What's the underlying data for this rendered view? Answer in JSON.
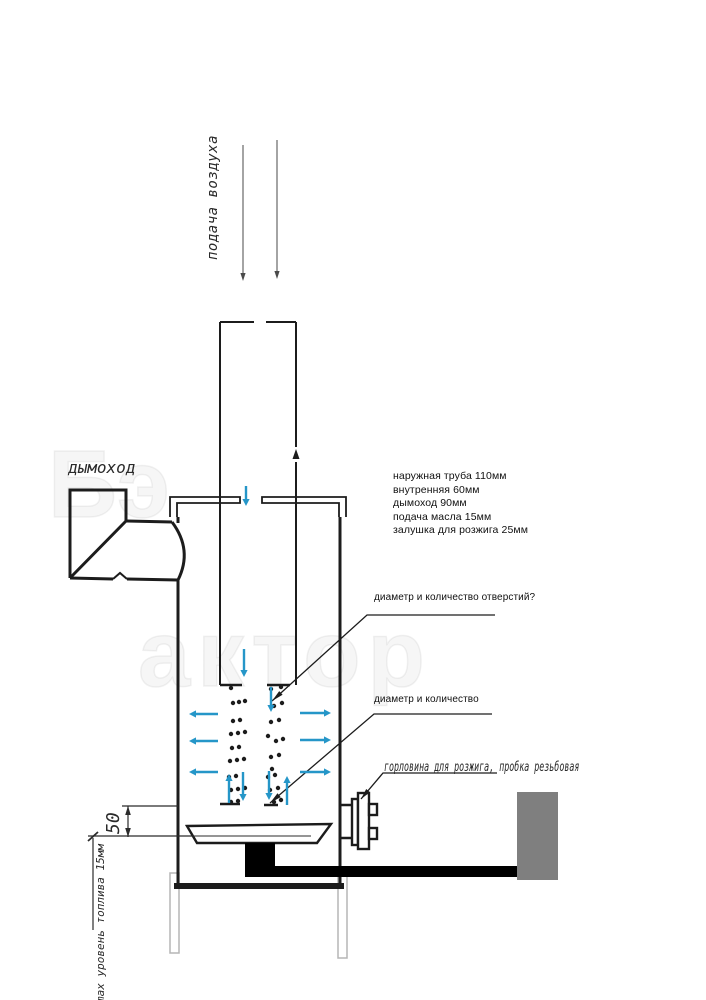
{
  "labels": {
    "air_supply": "подача воздуха",
    "chimney": "дымоход",
    "dim_50": "50",
    "max_fuel_level": "max уровень топлива 15мм",
    "ignition_port": "горловина для розжига, пробка резьбовая",
    "holes_question_top": "диаметр и количество отверстий?",
    "holes_question_bottom": "диаметр и количество",
    "specs": [
      "наружная труба 110мм",
      "внутренняя 60мм",
      "дымоход 90мм",
      "подача масла 15мм",
      "залушка для розжига 25мм"
    ]
  },
  "watermark": {
    "fragment_top": "Бэ",
    "fragment_mid": "актор"
  },
  "colors": {
    "line": "#1c1c1c",
    "flow_arrow": "#2596c8",
    "air_arrow": "#4a4a4a",
    "oil_pipe": "#000000",
    "oil_tank": "#7f7f7f",
    "dimension": "#2b2b2b",
    "legs": "#b5b5b5"
  },
  "diagram": {
    "flow_arrows": [
      {
        "x1": 246,
        "y1": 486,
        "x2": 246,
        "y2": 506
      },
      {
        "x1": 244,
        "y1": 649,
        "x2": 244,
        "y2": 677
      },
      {
        "x1": 271,
        "y1": 687,
        "x2": 271,
        "y2": 712
      },
      {
        "x1": 243,
        "y1": 772,
        "x2": 243,
        "y2": 801
      },
      {
        "x1": 269,
        "y1": 771,
        "x2": 269,
        "y2": 800
      },
      {
        "x1": 229,
        "y1": 803,
        "x2": 229,
        "y2": 774
      },
      {
        "x1": 287,
        "y1": 805,
        "x2": 287,
        "y2": 776
      },
      {
        "x1": 218,
        "y1": 714,
        "x2": 189,
        "y2": 714
      },
      {
        "x1": 218,
        "y1": 741,
        "x2": 189,
        "y2": 741
      },
      {
        "x1": 218,
        "y1": 772,
        "x2": 189,
        "y2": 772
      },
      {
        "x1": 300,
        "y1": 713,
        "x2": 331,
        "y2": 713
      },
      {
        "x1": 300,
        "y1": 740,
        "x2": 331,
        "y2": 740
      },
      {
        "x1": 300,
        "y1": 772,
        "x2": 331,
        "y2": 772
      }
    ],
    "air_arrows": [
      {
        "x1": 243,
        "y1": 145,
        "x2": 243,
        "y2": 281
      },
      {
        "x1": 277,
        "y1": 140,
        "x2": 277,
        "y2": 279
      }
    ],
    "holes": [
      [
        231,
        688
      ],
      [
        233,
        703
      ],
      [
        239,
        702
      ],
      [
        245,
        701
      ],
      [
        233,
        721
      ],
      [
        240,
        720
      ],
      [
        231,
        734
      ],
      [
        238,
        733
      ],
      [
        245,
        732
      ],
      [
        232,
        748
      ],
      [
        239,
        747
      ],
      [
        230,
        761
      ],
      [
        237,
        760
      ],
      [
        244,
        759
      ],
      [
        229,
        777
      ],
      [
        236,
        776
      ],
      [
        231,
        790
      ],
      [
        238,
        789
      ],
      [
        245,
        788
      ],
      [
        231,
        802
      ],
      [
        238,
        801
      ],
      [
        271,
        689
      ],
      [
        281,
        687
      ],
      [
        274,
        706
      ],
      [
        282,
        703
      ],
      [
        271,
        722
      ],
      [
        279,
        720
      ],
      [
        268,
        736
      ],
      [
        276,
        741
      ],
      [
        283,
        739
      ],
      [
        271,
        757
      ],
      [
        279,
        755
      ],
      [
        272,
        769
      ],
      [
        268,
        777
      ],
      [
        275,
        775
      ],
      [
        270,
        790
      ],
      [
        278,
        788
      ],
      [
        274,
        802
      ],
      [
        281,
        800
      ]
    ]
  }
}
